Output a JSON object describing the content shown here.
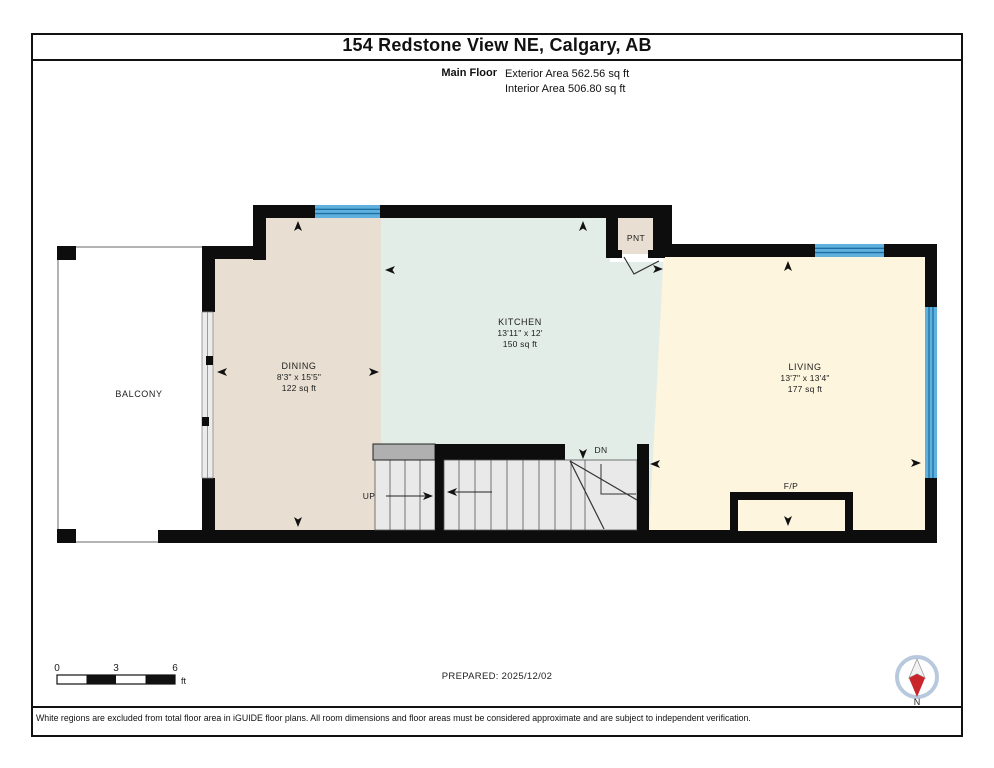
{
  "header": {
    "title": "154 Redstone View NE, Calgary, AB",
    "floor_label": "Main Floor",
    "exterior_area": "Exterior Area 562.56 sq ft",
    "interior_area": "Interior Area 506.80 sq ft"
  },
  "rooms": {
    "balcony": {
      "name": "BALCONY"
    },
    "dining": {
      "name": "DINING",
      "dims": "8'3\" x 15'5\"",
      "area": "122 sq ft"
    },
    "kitchen": {
      "name": "KITCHEN",
      "dims": "13'11\" x 12'",
      "area": "150 sq ft"
    },
    "living": {
      "name": "LIVING",
      "dims": "13'7\" x 13'4\"",
      "area": "177 sq ft"
    },
    "pantry": {
      "name": "PNT"
    },
    "fireplace": {
      "name": "F/P"
    }
  },
  "stairs": {
    "up_label": "UP",
    "down_label": "DN"
  },
  "scale_bar": {
    "tick_0": "0",
    "tick_3": "3",
    "tick_6": "6",
    "unit": "ft"
  },
  "compass": {
    "north_label": "N"
  },
  "footer": {
    "prepared": "PREPARED: 2025/12/02",
    "disclaimer": "White regions are excluded from total floor area in iGUIDE floor plans. All room dimensions and floor areas must be considered approximate and are subject to independent verification."
  },
  "colors": {
    "wall": "#0d0d0d",
    "dining_floor": "#e8dfd2",
    "kitchen_floor": "#e3ede8",
    "living_floor": "#fdf5dd",
    "stair_floor": "#e9e9e9",
    "railing_gray": "#b0b0b0",
    "window_blue": "#5fb0dd",
    "window_line": "#1d6fa3",
    "compass_red": "#c9252b"
  }
}
